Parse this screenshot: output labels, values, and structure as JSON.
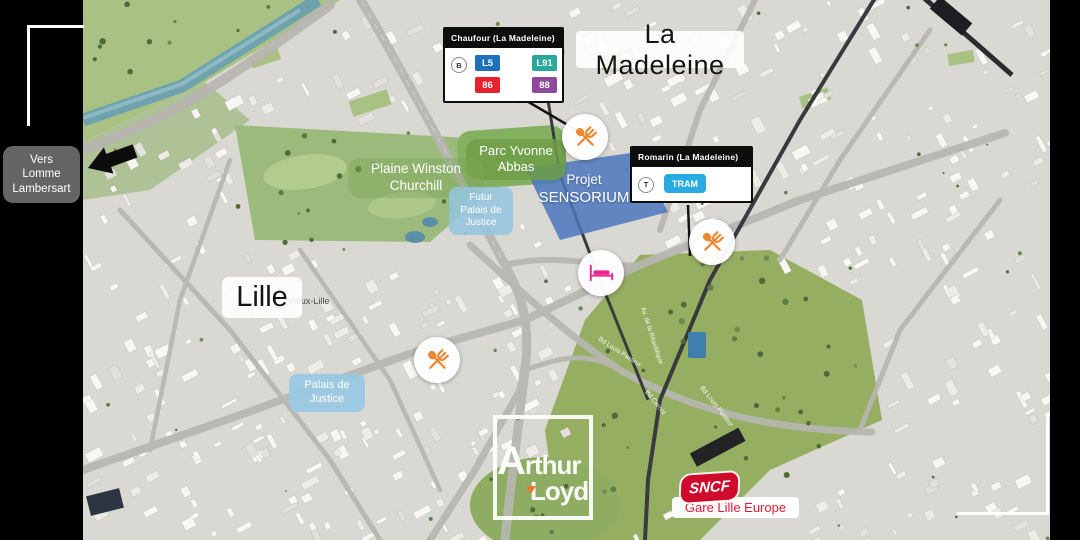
{
  "title_labels": {
    "la_madeleine": "La Madeleine",
    "lille": "Lille",
    "vieux_lille": "Vieux-Lille"
  },
  "direction_sign": {
    "line1": "Vers",
    "line2": "Lomme",
    "line3": "Lambersart"
  },
  "transit_cards": {
    "chaufour": {
      "title": "Chaufour (La Madeleine)",
      "mode_letter": "B",
      "badges": [
        {
          "label": "L5",
          "color": "#1d71b8"
        },
        {
          "label": "L91",
          "color": "#2aa79b"
        },
        {
          "label": "86",
          "color": "#e8212e"
        },
        {
          "label": "88",
          "color": "#8d4a9b"
        }
      ]
    },
    "romarin": {
      "title": "Romarin (La Madeleine)",
      "mode_letter": "T",
      "badges": [
        {
          "label": "TRAM",
          "color": "#29abe2"
        }
      ]
    }
  },
  "area_labels": {
    "parc_yvonne": {
      "line1": "Parc Yvonne",
      "line2": "Abbas"
    },
    "churchill": {
      "line1": "Plaine Winston",
      "line2": "Churchill"
    },
    "sensorium": {
      "line1": "Projet",
      "line2": "SENSORIUM"
    },
    "futur_palais": {
      "line1": "Futur",
      "line2": "Palais de",
      "line3": "Justice"
    },
    "palais": {
      "line1": "Palais de",
      "line2": "Justice"
    }
  },
  "street_labels": [
    "Bd Louis Pasteur",
    "Av. de la République",
    "Bd Carnot",
    "Bd Louis Pasteur"
  ],
  "station": {
    "brand": "SNCF",
    "name": "Gare Lille Europe",
    "brand_color": "#cf0a2c",
    "text_color": "#e31837"
  },
  "watermark": {
    "letter": "A",
    "rest1": "rthur",
    "line2": "Loyd",
    "accent_color": "#e8762d"
  },
  "markers": {
    "restaurant_color": "#ed8833",
    "hotel_color": "#ec268f"
  }
}
